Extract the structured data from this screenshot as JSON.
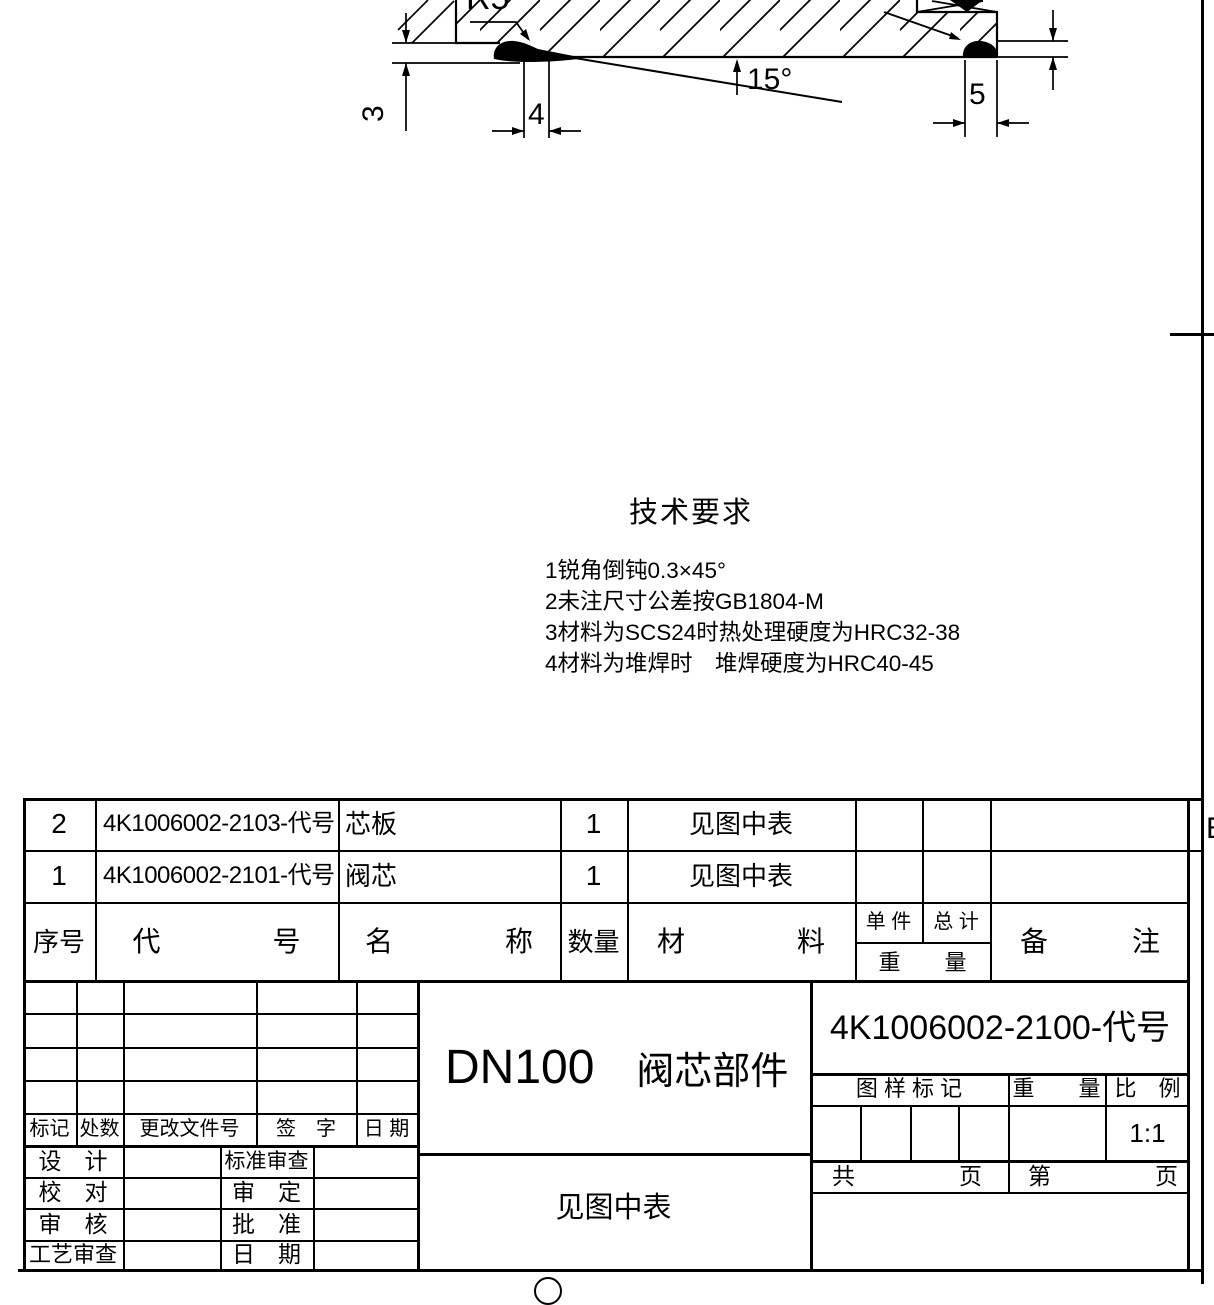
{
  "view": {
    "dim_radius": "R5",
    "dim_angle": "15°",
    "dim_step_height": "3",
    "dim_left_face": "4",
    "dim_right_face": "5",
    "zone_letter": "B"
  },
  "tech": {
    "title": "技术要求",
    "items": [
      "1锐角倒钝0.3×45°",
      "2未注尺寸公差按GB1804-M",
      "3材料为SCS24时热处理硬度为HRC32-38",
      "4材料为堆焊时　堆焊硬度为HRC40-45"
    ]
  },
  "parts": {
    "headers": {
      "seq": "序号",
      "code": "代　　　　号",
      "name": "名　　　　称",
      "qty": "数量",
      "material": "材　　　　料",
      "unit": "单 件",
      "total": "总 计",
      "weight": "重　　量",
      "remark": "备　　　注"
    },
    "rows": [
      {
        "seq": "2",
        "code": "4K1006002-2103-代号",
        "name": "芯板",
        "qty": "1",
        "material": "见图中表"
      },
      {
        "seq": "1",
        "code": "4K1006002-2101-代号",
        "name": "阀芯",
        "qty": "1",
        "material": "见图中表"
      }
    ]
  },
  "titleblock": {
    "revision": {
      "mark": "标记",
      "count": "处数",
      "doc": "更改文件号",
      "sign": "签　字",
      "date": "日 期"
    },
    "signoff": [
      {
        "label": "设　计",
        "label2": "标准审查"
      },
      {
        "label": "校　对",
        "label2": "审　定"
      },
      {
        "label": "审　核",
        "label2": "批　准"
      },
      {
        "label": "工艺审查",
        "label2": "日　期"
      }
    ],
    "model": "DN100",
    "product": "阀芯部件",
    "material_note": "见图中表",
    "drawing_no": "4K1006002-2100-代号",
    "stamp": {
      "mark": "图 样 标 记",
      "weight": "重　　量",
      "scale": "比　例",
      "scale_value": "1:1"
    },
    "pages": {
      "total_label": "共",
      "total_unit": "页",
      "page_label": "第",
      "page_unit": "页"
    }
  }
}
